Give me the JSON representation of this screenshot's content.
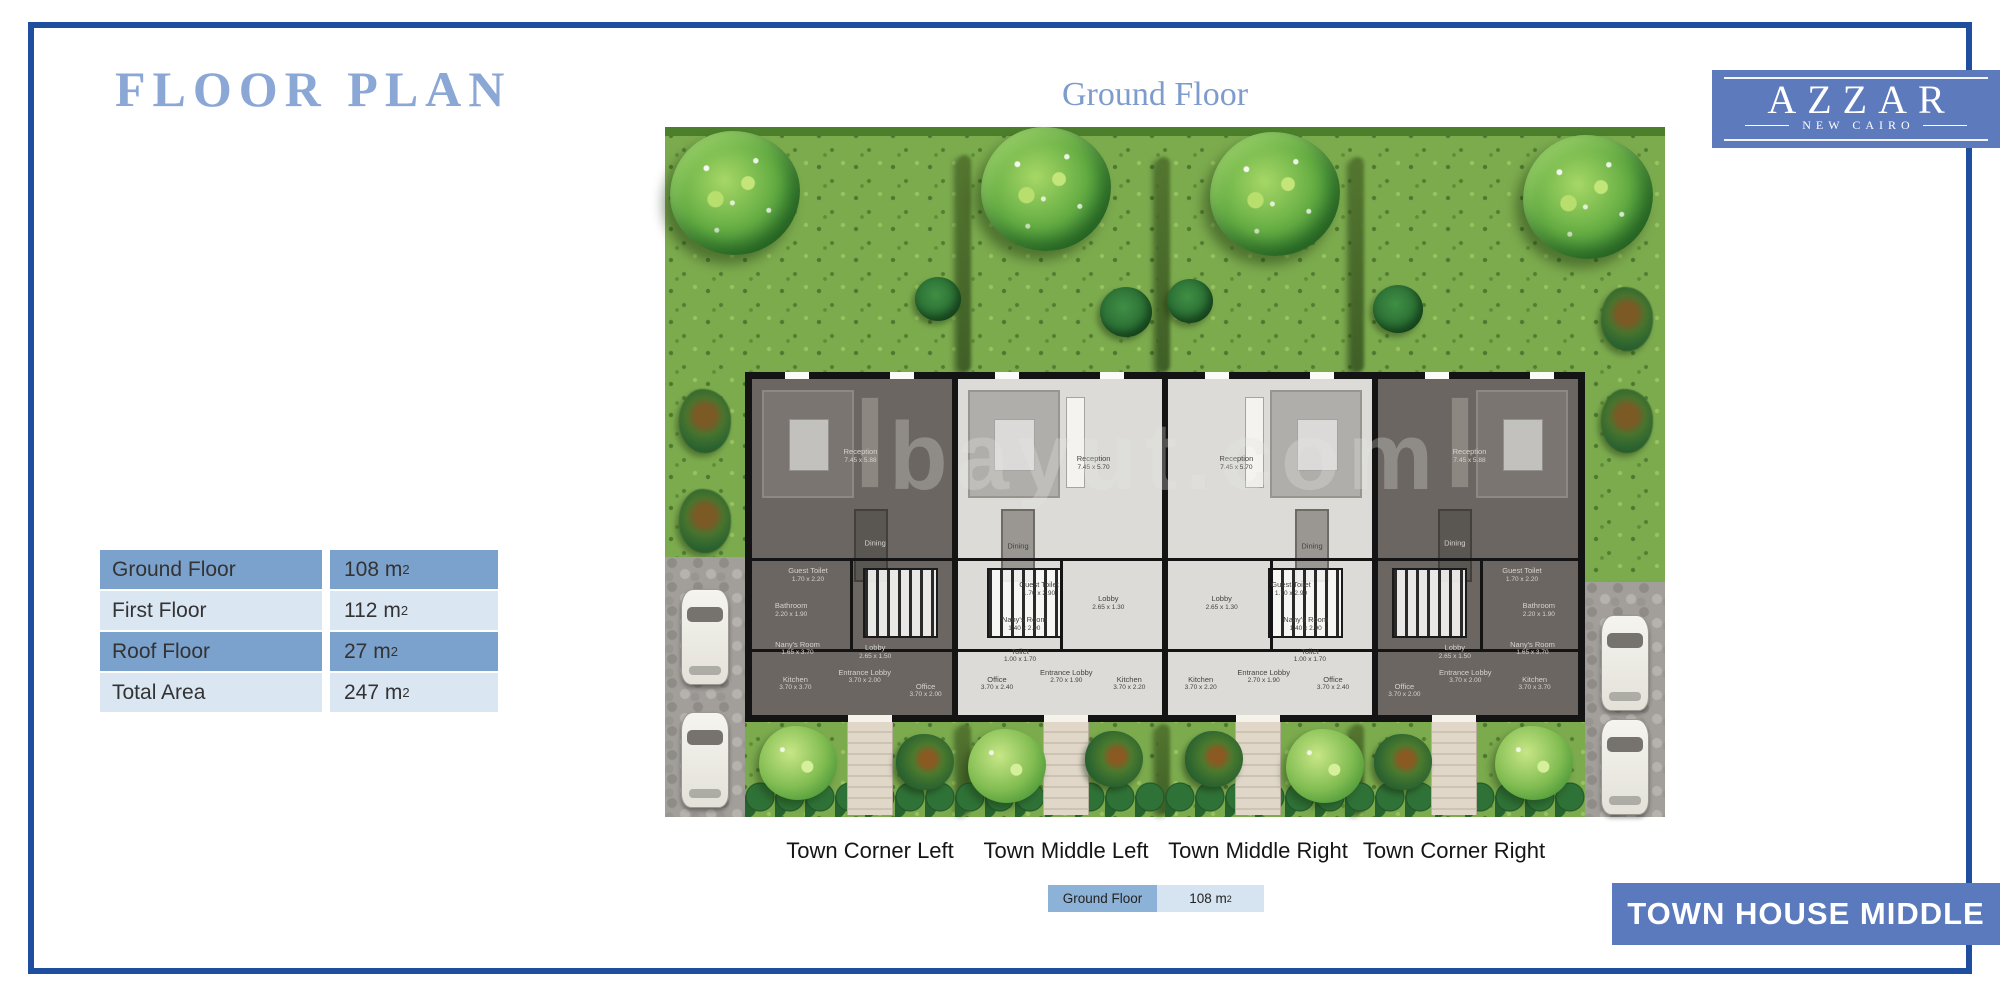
{
  "page": {
    "title": "FLOOR PLAN",
    "floor_heading": "Ground Floor"
  },
  "logo": {
    "brand": "AZZAR",
    "location": "NEW CAIRO"
  },
  "colors": {
    "frame": "#1e4e9d",
    "title_text": "#8ba7d5",
    "accent_band": "#5d7abc",
    "banner": "#5b79bd",
    "table_row_dark": "#7ba1cd",
    "table_row_light": "#dbe6f3",
    "legend_dark": "#8db2d7",
    "legend_light": "#d6e3f0"
  },
  "area_table": {
    "rows": [
      {
        "label": "Ground Floor",
        "value": "108",
        "unit": "m",
        "exp": "2"
      },
      {
        "label": "First Floor",
        "value": "112",
        "unit": "m",
        "exp": "2"
      },
      {
        "label": "Roof Floor",
        "value": "27",
        "unit": "m",
        "exp": "2"
      },
      {
        "label": "Total Area",
        "value": "247",
        "unit": "m",
        "exp": "2"
      }
    ]
  },
  "legend": {
    "label": "Ground Floor",
    "value": "108",
    "unit": "m",
    "exp": "2"
  },
  "banner": {
    "text": "TOWN HOUSE MIDDLE"
  },
  "watermark": "bayut.com",
  "plan": {
    "unit_labels": [
      "Town Corner Left",
      "Town Middle Left",
      "Town Middle Right",
      "Town Corner Right"
    ],
    "units": [
      {
        "name": "Town Corner Left",
        "style": "dark",
        "rooms": [
          {
            "label": "Reception",
            "dims": "7.45 x 5.88",
            "x": 55,
            "y": 24
          },
          {
            "label": "Dining",
            "dims": "",
            "x": 62,
            "y": 49
          },
          {
            "label": "Guest Toilet",
            "dims": "1.70 x 2.20",
            "x": 30,
            "y": 58
          },
          {
            "label": "Bathroom",
            "dims": "2.20 x 1.90",
            "x": 22,
            "y": 68
          },
          {
            "label": "Nany's Room",
            "dims": "1.65 x 3.70",
            "x": 25,
            "y": 79
          },
          {
            "label": "Lobby",
            "dims": "2.65 x 1.50",
            "x": 62,
            "y": 80
          },
          {
            "label": "Kitchen",
            "dims": "3.70 x 3.70",
            "x": 24,
            "y": 89
          },
          {
            "label": "Entrance Lobby",
            "dims": "3.70 x 2.00",
            "x": 57,
            "y": 87
          },
          {
            "label": "Office",
            "dims": "3.70 x 2.00",
            "x": 86,
            "y": 91
          }
        ]
      },
      {
        "name": "Town Middle Left",
        "style": "light",
        "rooms": [
          {
            "label": "Reception",
            "dims": "7.45 x 5.70",
            "x": 66,
            "y": 26
          },
          {
            "label": "Dining",
            "dims": "",
            "x": 30,
            "y": 50
          },
          {
            "label": "Guest Toilet",
            "dims": "1.70 x 2.90",
            "x": 40,
            "y": 62
          },
          {
            "label": "Nany's Room",
            "dims": "1.40 x 2.90",
            "x": 33,
            "y": 72
          },
          {
            "label": "Toilet",
            "dims": "1.00 x 1.70",
            "x": 31,
            "y": 81
          },
          {
            "label": "Lobby",
            "dims": "2.65 x 1.30",
            "x": 73,
            "y": 66
          },
          {
            "label": "Office",
            "dims": "3.70 x 2.40",
            "x": 20,
            "y": 89
          },
          {
            "label": "Entrance Lobby",
            "dims": "2.70 x 1.90",
            "x": 53,
            "y": 87
          },
          {
            "label": "Kitchen",
            "dims": "3.70 x 2.20",
            "x": 83,
            "y": 89
          }
        ]
      },
      {
        "name": "Town Middle Right",
        "style": "light",
        "rooms": [
          {
            "label": "Reception",
            "dims": "7.45 x 5.70",
            "x": 34,
            "y": 26
          },
          {
            "label": "Dining",
            "dims": "",
            "x": 70,
            "y": 50
          },
          {
            "label": "Guest Toilet",
            "dims": "1.70 x 2.90",
            "x": 60,
            "y": 62
          },
          {
            "label": "Nany's Room",
            "dims": "1.40 x 2.90",
            "x": 67,
            "y": 72
          },
          {
            "label": "Toilet",
            "dims": "1.00 x 1.70",
            "x": 69,
            "y": 81
          },
          {
            "label": "Lobby",
            "dims": "2.65 x 1.30",
            "x": 27,
            "y": 66
          },
          {
            "label": "Office",
            "dims": "3.70 x 2.40",
            "x": 80,
            "y": 89
          },
          {
            "label": "Entrance Lobby",
            "dims": "2.70 x 1.90",
            "x": 47,
            "y": 87
          },
          {
            "label": "Kitchen",
            "dims": "3.70 x 2.20",
            "x": 17,
            "y": 89
          }
        ]
      },
      {
        "name": "Town Corner Right",
        "style": "dark",
        "rooms": [
          {
            "label": "Reception",
            "dims": "7.45 x 5.88",
            "x": 45,
            "y": 24
          },
          {
            "label": "Dining",
            "dims": "",
            "x": 38,
            "y": 49
          },
          {
            "label": "Guest Toilet",
            "dims": "1.70 x 2.20",
            "x": 70,
            "y": 58
          },
          {
            "label": "Bathroom",
            "dims": "2.20 x 1.90",
            "x": 78,
            "y": 68
          },
          {
            "label": "Nany's Room",
            "dims": "1.65 x 3.70",
            "x": 75,
            "y": 79
          },
          {
            "label": "Lobby",
            "dims": "2.65 x 1.50",
            "x": 38,
            "y": 80
          },
          {
            "label": "Kitchen",
            "dims": "3.70 x 3.70",
            "x": 76,
            "y": 89
          },
          {
            "label": "Entrance Lobby",
            "dims": "3.70 x 2.00",
            "x": 43,
            "y": 87
          },
          {
            "label": "Office",
            "dims": "3.70 x 2.00",
            "x": 14,
            "y": 91
          }
        ]
      }
    ]
  }
}
